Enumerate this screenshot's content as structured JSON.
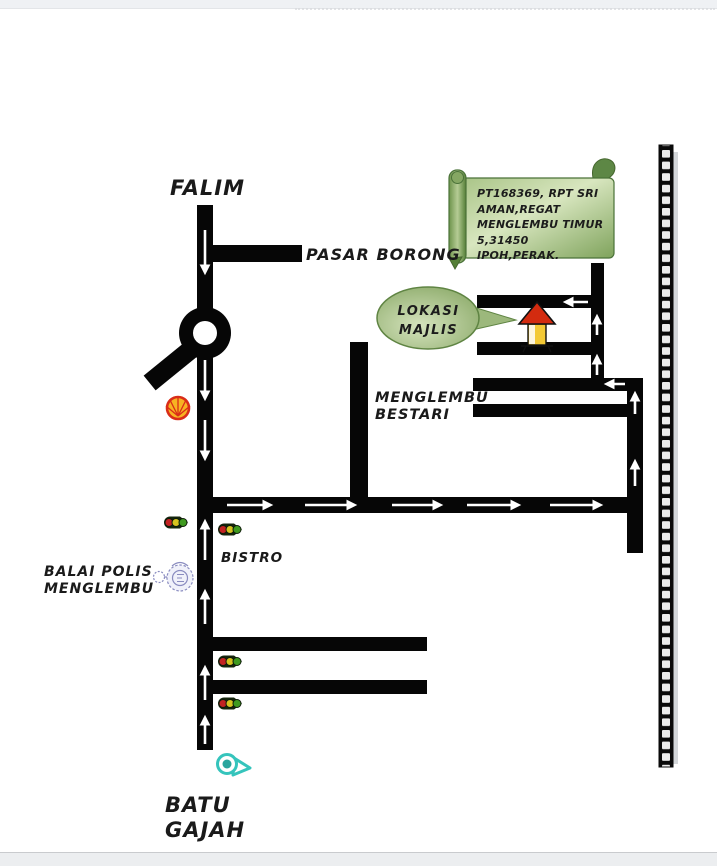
{
  "window": {
    "top_bar_color": "#eff1f4",
    "bottom_bar_color": "#eceef0",
    "canvas_color": "#ffffff"
  },
  "map": {
    "labels": {
      "falim": "FALIM",
      "pasar_borong": "PASAR BORONG",
      "menglembu_bestari": {
        "line1": "MENGLEMBU",
        "line2": "BESTARI"
      },
      "bistro": "BISTRO",
      "balai_polis": {
        "line1": "BALAI POLIS",
        "line2": "MENGLEMBU"
      },
      "batu_gajah": {
        "line1": "BATU",
        "line2": "GAJAH"
      }
    },
    "address_scroll": {
      "lines": [
        "PT168369, RPT SRI",
        "AMAN,REGAT",
        "MENGLEMBU TIMUR",
        "5,31450 IPOH,PERAK."
      ]
    },
    "location_bubble": {
      "line1": "LOKASI",
      "line2": "MAJLIS"
    },
    "colors": {
      "road": "#060606",
      "arrow": "#ffffff",
      "scroll_light": "#d8e6bf",
      "scroll_mid": "#a9c487",
      "scroll_dark": "#7fa35c",
      "scroll_roll_dark": "#557f37",
      "scroll_stroke": "#4a7238",
      "bubble_light": "#d5e3bd",
      "bubble_dark": "#85a562",
      "bubble_stroke": "#5f8443",
      "house_roof": "#d32b0f",
      "house_body": "#f3c935",
      "shell_red": "#da2d18",
      "shell_yellow": "#f7b322",
      "traffic_body": "#15250d",
      "traffic_red": "#c32222",
      "traffic_yellow": "#d6c31f",
      "traffic_green": "#3f9a1f",
      "badge_blue": "#8a8cc0",
      "whistle_teal": "#35c4bc",
      "film_strip": "#0a0a0a"
    },
    "icons": {
      "roundabout": "black donut junction",
      "shell-station-icon": "red-yellow scallop shell petrol station",
      "traffic-light-icon": "horizontal red-yellow-green signal",
      "police-badge-icon": "blue police crest",
      "whistle-icon": "teal whistle",
      "house-icon": "red roof yellow house (destination)",
      "film-strip": "vertical film strip border",
      "address-scroll": "green parchment scroll",
      "location-bubble": "green speech balloon"
    }
  }
}
